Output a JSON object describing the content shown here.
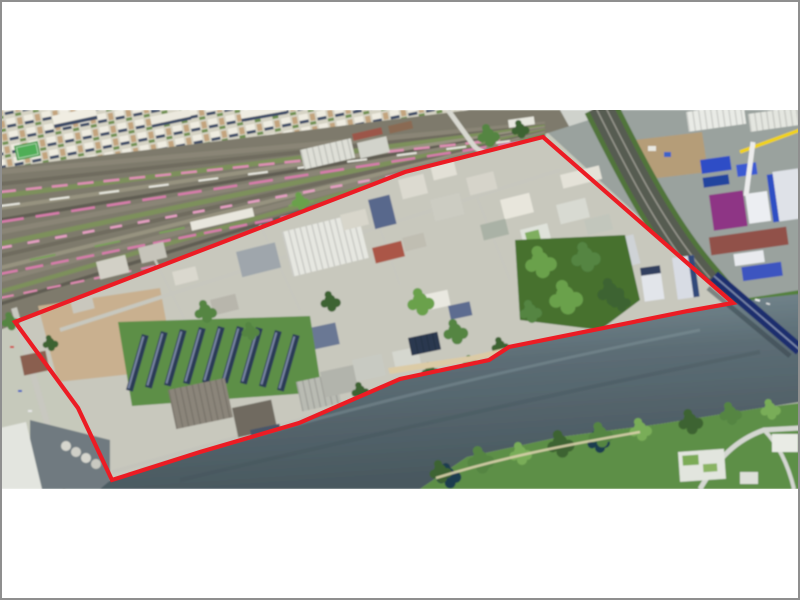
{
  "figure": {
    "kind": "aerial-photograph",
    "description_visible_content": "Oblique aerial photo of a riverside industrial district outlined with a red boundary; railway yard with pink train sets upper left, dense housing top left corner, industrial plant right, river with bridge lower right, green park on far bank",
    "photo": {
      "left": 0,
      "top": 110,
      "width": 800,
      "height": 379
    }
  },
  "boundary": {
    "color": "#ec1c24",
    "stroke_width": 4.2,
    "points": "15,322 405,172 543,137 733,303 688,311 509,347 489,360 400,379 299,423 200,452 112,480 78,408"
  },
  "palette": {
    "canvas_white": "#ffffff",
    "frame_gray": "#8f8f8f",
    "boundary_red": "#ec1c24",
    "river": "#5c6d75",
    "river_deep": "#49585f",
    "vegetation": "#5d8f46",
    "vegetation_dark": "#3c6330",
    "train_pink": "#de8fb4",
    "rail_bed": "#8a8576",
    "buildings_light": "#e9e8df",
    "shadow_blue": "#33497a",
    "industrial_blue": "#2f4fc4",
    "purple_building": "#8e3585",
    "dirt_lot": "#c9b08f",
    "sand": "#dbcba6",
    "bridge_navy": "#1e2e6e",
    "crane_yellow": "#f2d313"
  },
  "landmarks": [
    "railway-yard",
    "residential-blocks",
    "industrial-district",
    "row-houses",
    "vacant-dirt-lot",
    "riverside-warehouses",
    "central-park-trees",
    "high-rise-towers",
    "industrial-plant",
    "construction-site",
    "river",
    "bridge",
    "far-bank-park"
  ]
}
